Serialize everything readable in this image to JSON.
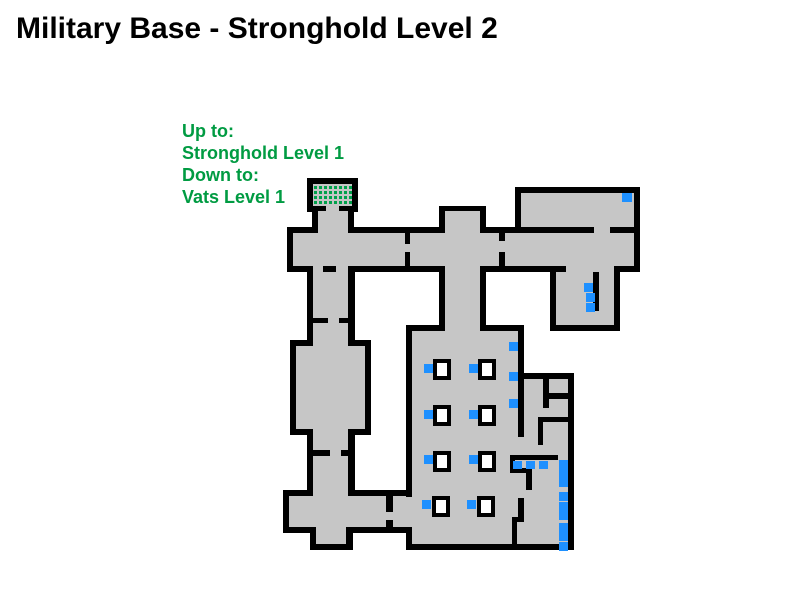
{
  "title": "Military Base - Stronghold Level 2",
  "legend": {
    "lines": [
      "Up to:",
      "Stronghold Level 1",
      "Down to:",
      "Vats Level 1"
    ]
  },
  "map": {
    "colors": {
      "background": "#ffffff",
      "floor": "#C6C6C6",
      "wall": "#000000",
      "marker_blue": "#1E90FF",
      "stairs_green": "#00A14B",
      "legend_green": "#009B42",
      "object_fill": "#FFFFFF"
    },
    "rooms_outer": [
      [
        287,
        227,
        218,
        45
      ],
      [
        499,
        227,
        141,
        45
      ],
      [
        515,
        187,
        125,
        46
      ],
      [
        307,
        178,
        51,
        34
      ],
      [
        312,
        206,
        42,
        27
      ],
      [
        439,
        206,
        47,
        27
      ],
      [
        439,
        266,
        47,
        65
      ],
      [
        550,
        266,
        70,
        65
      ],
      [
        307,
        266,
        48,
        75
      ],
      [
        290,
        340,
        81,
        95
      ],
      [
        307,
        429,
        48,
        68
      ],
      [
        283,
        490,
        129,
        43
      ],
      [
        310,
        527,
        43,
        23
      ],
      [
        406,
        325,
        118,
        225
      ],
      [
        518,
        373,
        56,
        177
      ]
    ],
    "floors": [
      [
        293,
        233,
        206,
        33
      ],
      [
        505,
        233,
        129,
        33
      ],
      [
        521,
        193,
        113,
        34
      ],
      [
        313,
        184,
        39,
        22
      ],
      [
        318,
        211,
        30,
        22
      ],
      [
        445,
        211,
        35,
        25
      ],
      [
        445,
        266,
        35,
        65
      ],
      [
        556,
        272,
        58,
        53
      ],
      [
        313,
        272,
        35,
        69
      ],
      [
        296,
        346,
        69,
        83
      ],
      [
        313,
        429,
        35,
        68
      ],
      [
        289,
        496,
        117,
        31
      ],
      [
        316,
        527,
        30,
        17
      ],
      [
        412,
        331,
        106,
        213
      ],
      [
        524,
        379,
        44,
        165
      ],
      [
        518,
        437,
        6,
        107
      ]
    ],
    "openings": [
      [
        326,
        202,
        13,
        12
      ],
      [
        313,
        264,
        35,
        10
      ],
      [
        497,
        241,
        10,
        11
      ],
      [
        594,
        225,
        16,
        10
      ],
      [
        566,
        264,
        48,
        10
      ],
      [
        313,
        339,
        35,
        9
      ],
      [
        404,
        497,
        10,
        30
      ]
    ],
    "inner_walls": [
      [
        323,
        266,
        13,
        6
      ],
      [
        405,
        233,
        5,
        11
      ],
      [
        405,
        252,
        5,
        14
      ],
      [
        313,
        318,
        15,
        5
      ],
      [
        339,
        318,
        9,
        5
      ],
      [
        313,
        450,
        17,
        6
      ],
      [
        341,
        450,
        7,
        6
      ],
      [
        386,
        496,
        7,
        16
      ],
      [
        386,
        520,
        7,
        7
      ],
      [
        593,
        272,
        6,
        39
      ],
      [
        543,
        379,
        6,
        29
      ],
      [
        549,
        393,
        19,
        6
      ],
      [
        538,
        417,
        30,
        5
      ],
      [
        538,
        417,
        5,
        28
      ],
      [
        510,
        455,
        48,
        5
      ],
      [
        510,
        455,
        5,
        18
      ],
      [
        510,
        468,
        22,
        5
      ],
      [
        526,
        473,
        6,
        17
      ],
      [
        518,
        498,
        6,
        24
      ],
      [
        512,
        517,
        12,
        5
      ],
      [
        512,
        522,
        5,
        22
      ]
    ],
    "objects": [
      [
        433,
        359
      ],
      [
        478,
        359
      ],
      [
        433,
        405
      ],
      [
        478,
        405
      ],
      [
        433,
        451
      ],
      [
        478,
        451
      ],
      [
        432,
        496
      ],
      [
        477,
        496
      ]
    ],
    "object_size": {
      "w": 18,
      "h": 21,
      "border": 4
    },
    "markers": [
      [
        622,
        193,
        10,
        9
      ],
      [
        584,
        283,
        9,
        9
      ],
      [
        586,
        293,
        9,
        9
      ],
      [
        586,
        303,
        9,
        9
      ],
      [
        509,
        342,
        9,
        9
      ],
      [
        509,
        372,
        9,
        9
      ],
      [
        509,
        399,
        9,
        9
      ],
      [
        424,
        364,
        9,
        9
      ],
      [
        469,
        364,
        9,
        9
      ],
      [
        424,
        410,
        9,
        9
      ],
      [
        469,
        410,
        9,
        9
      ],
      [
        424,
        455,
        9,
        9
      ],
      [
        469,
        455,
        9,
        9
      ],
      [
        422,
        500,
        9,
        9
      ],
      [
        467,
        500,
        9,
        9
      ],
      [
        513,
        461,
        9,
        8
      ],
      [
        526,
        461,
        9,
        8
      ],
      [
        539,
        461,
        9,
        8
      ],
      [
        559,
        460,
        9,
        9
      ],
      [
        559,
        469,
        9,
        9
      ],
      [
        559,
        478,
        9,
        9
      ],
      [
        559,
        492,
        9,
        9
      ],
      [
        559,
        502,
        9,
        9
      ],
      [
        559,
        511,
        9,
        9
      ],
      [
        559,
        523,
        9,
        9
      ],
      [
        559,
        532,
        9,
        9
      ],
      [
        559,
        542,
        9,
        9
      ]
    ],
    "stairs_pattern": {
      "x": 314,
      "y": 186,
      "cols": 8,
      "rows": 4,
      "dot_size": 3,
      "pitch": 5
    }
  }
}
